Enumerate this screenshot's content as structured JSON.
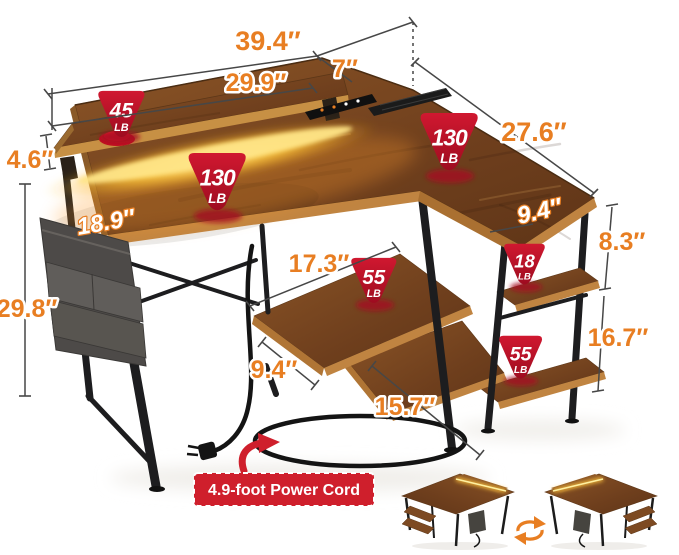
{
  "title": "L-shaped desk dimension diagram",
  "dims": {
    "total_width": "39.4″",
    "shelf_width": "29.9″",
    "back_extension": "7″",
    "wing_depth": "27.6″",
    "shelf_height": "4.6″",
    "desk_depth": "18.9″",
    "desk_height": "29.8″",
    "wing_top_depth": "9.4″",
    "upper_shelf_gap": "8.3″",
    "lower_shelf_gap": "16.7″",
    "mid_shelf_width": "17.3″",
    "mid_shelf_depth": "9.4″",
    "bottom_shelf_width": "15.7″"
  },
  "badges": [
    {
      "value": "45",
      "unit": "LB"
    },
    {
      "value": "130",
      "unit": "LB"
    },
    {
      "value": "130",
      "unit": "LB"
    },
    {
      "value": "55",
      "unit": "LB"
    },
    {
      "value": "18",
      "unit": "LB"
    },
    {
      "value": "55",
      "unit": "LB"
    }
  ],
  "callout": {
    "power_cord": "4.9-foot Power Cord"
  },
  "colors": {
    "accent_orange": "#E87E22",
    "badge_red": "#C01330",
    "callout_red": "#CF1F2C",
    "wood_brown": "#7D4A22",
    "led_glow": "#FFC93D"
  }
}
